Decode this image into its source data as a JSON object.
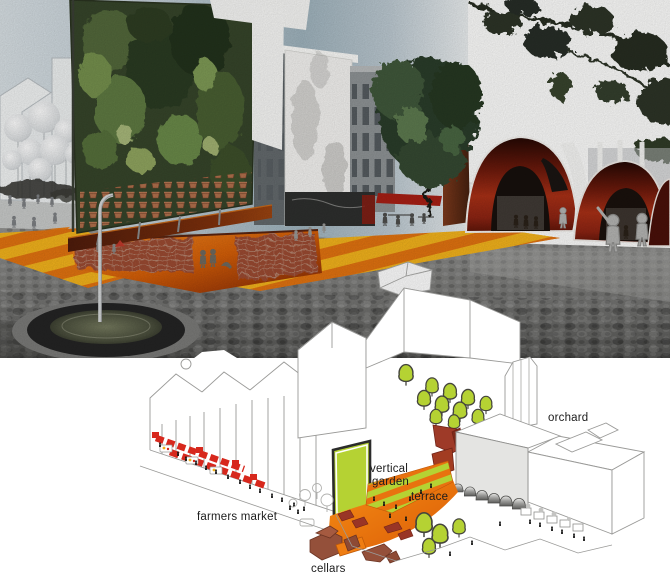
{
  "diagram": {
    "labels": {
      "orchard": "orchard",
      "vertical_garden_line1": "vertical",
      "vertical_garden_line2": "garden",
      "terrace": "terrace",
      "farmers_market": "farmers market",
      "cellars": "cellars"
    }
  },
  "palette": {
    "lime_green": "#b5d233",
    "plaza_orange": "#f0780f",
    "stripe_orange": "#e8720f",
    "stair_yellow": "#f3b31c",
    "stair_orange": "#e27310",
    "stall_red": "#d7281d",
    "vault_red": "#8d2413",
    "furniture_dark_red": "#993526",
    "cellar_brown": "#94503a",
    "cobble_gray": "#6b6b69",
    "outline_gray": "#9a9a98",
    "label_black": "#1c1c1c"
  }
}
